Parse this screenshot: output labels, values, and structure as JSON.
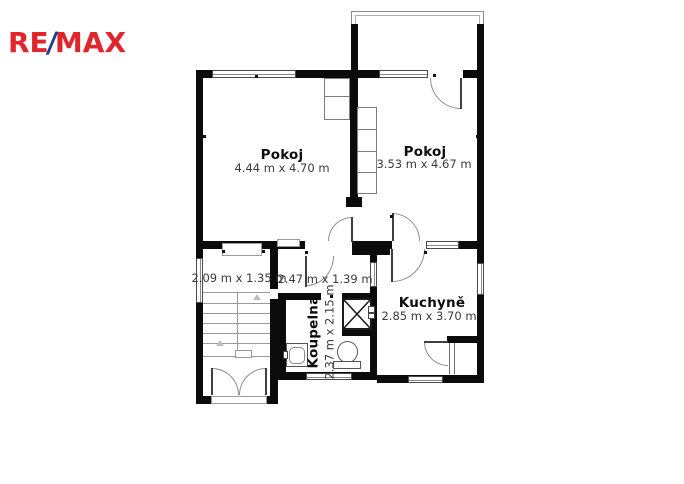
{
  "logo": {
    "re": "RE",
    "slash": "/",
    "max": "MAX"
  },
  "colors": {
    "logo_red": "#e0252c",
    "logo_blue": "#1d3d8f",
    "wall_black": "#0b0b0b",
    "line_gray": "#8f8f8f"
  },
  "rooms": {
    "pokoj_left": {
      "name": "Pokoj",
      "dims": "4.44 m x 4.70 m"
    },
    "pokoj_right": {
      "name": "Pokoj",
      "dims": "3.53 m x 4.67 m"
    },
    "kuchyne": {
      "name": "Kuchyně",
      "dims": "2.85 m x 3.70 m"
    },
    "koupelna": {
      "name": "Koupelna",
      "dims": "2.37 m x 2.15 m"
    },
    "hall_landing": {
      "dims": "2.09 m x 1.35 m"
    },
    "hall_middle": {
      "dims": "2.47 m x 1.39 m"
    }
  }
}
